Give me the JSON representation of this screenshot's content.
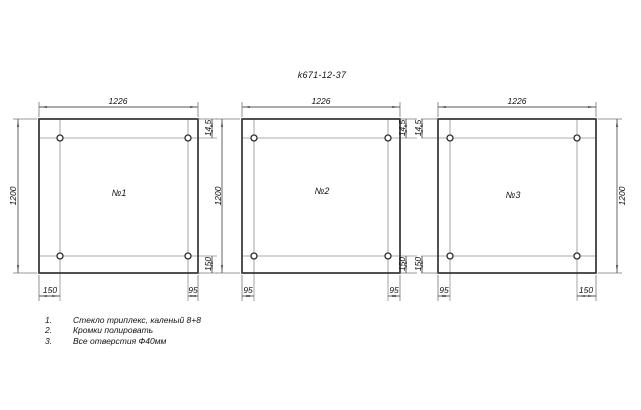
{
  "title": "k671-12-37",
  "colors": {
    "background": "#ffffff",
    "outline": "#3c3c3c",
    "dim_lines": "#555555",
    "text": "#111111"
  },
  "panels": [
    {
      "label": "№1",
      "dims": {
        "width": "1226",
        "height": "1200",
        "hole_top": "14,5",
        "hole_bottom": "150",
        "hole_left": "150",
        "hole_right": "95"
      }
    },
    {
      "label": "№2",
      "dims": {
        "width": "1226",
        "height": "1200",
        "hole_top": "14,5",
        "hole_bottom": "150",
        "hole_left": "95",
        "hole_right": "95"
      }
    },
    {
      "label": "№3",
      "dims": {
        "width": "1226",
        "height": "1200",
        "hole_top": "14,5",
        "hole_bottom": "150",
        "hole_left": "95",
        "hole_right": "150"
      }
    }
  ],
  "notes": [
    {
      "num": "1.",
      "text": "Стекло триплекс, каленый 8+8"
    },
    {
      "num": "2.",
      "text": "Кромки полировать"
    },
    {
      "num": "3.",
      "text": "Все отверстия Ф40мм"
    }
  ]
}
